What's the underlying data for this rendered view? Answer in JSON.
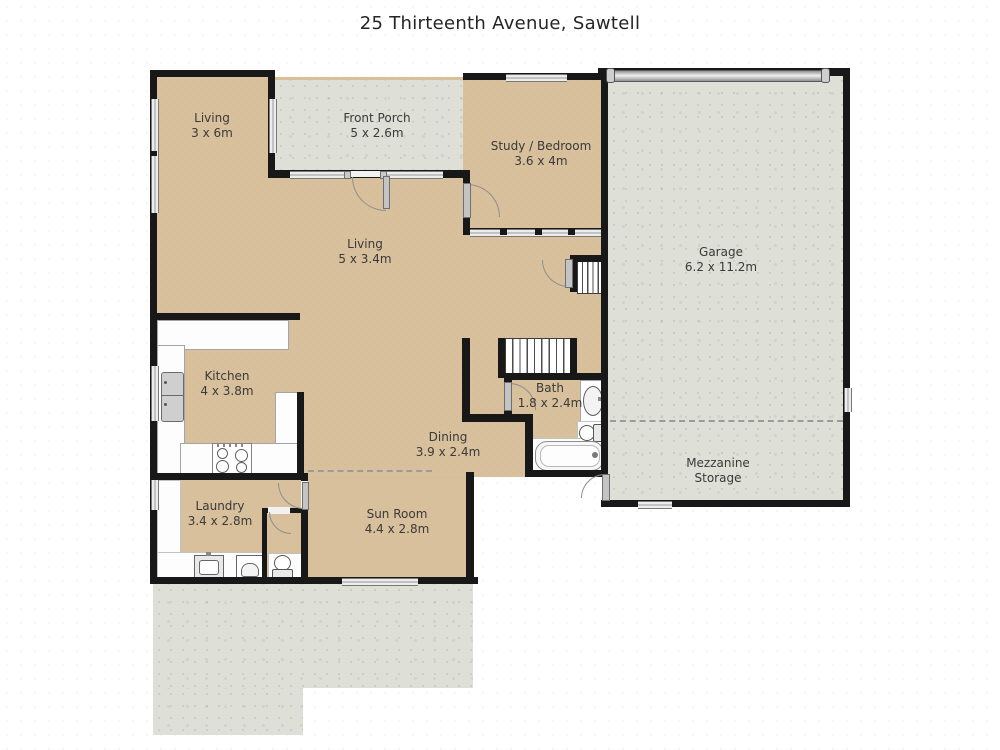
{
  "title": "25 Thirteenth Avenue, Sawtell",
  "rooms": {
    "living_upper": {
      "name": "Living",
      "dims": "3 x 6m"
    },
    "front_porch": {
      "name": "Front Porch",
      "dims": "5 x 2.6m"
    },
    "study_bedroom": {
      "name": "Study / Bedroom",
      "dims": "3.6 x 4m"
    },
    "garage": {
      "name": "Garage",
      "dims": "6.2 x 11.2m"
    },
    "living_main": {
      "name": "Living",
      "dims": "5 x 3.4m"
    },
    "kitchen": {
      "name": "Kitchen",
      "dims": "4 x 3.8m"
    },
    "bath": {
      "name": "Bath",
      "dims": "1.8 x 2.4m"
    },
    "dining": {
      "name": "Dining",
      "dims": "3.9 x 2.4m"
    },
    "laundry": {
      "name": "Laundry",
      "dims": "3.4 x 2.8m"
    },
    "sun_room": {
      "name": "Sun Room",
      "dims": "4.4 x 2.8m"
    },
    "mezzanine": {
      "name": "Mezzanine",
      "dims": "Storage"
    }
  },
  "colors": {
    "interior_floor": "#d7c09b",
    "exterior_floor": "#dedfd6",
    "wall": "#181818",
    "window": "#ececec",
    "accent_fixture": "#8f8f8f"
  },
  "icons": {
    "fridge": "fridge-icon",
    "stove": "stove-icon",
    "bath_sink": "sink-icon",
    "toilets": "toilet-icon",
    "bathtub": "bathtub-icon",
    "laundry_tub": "laundry-tub-icon",
    "washer": "washing-machine-icon",
    "garage_door": "garage-door",
    "stairs": "stairs"
  }
}
